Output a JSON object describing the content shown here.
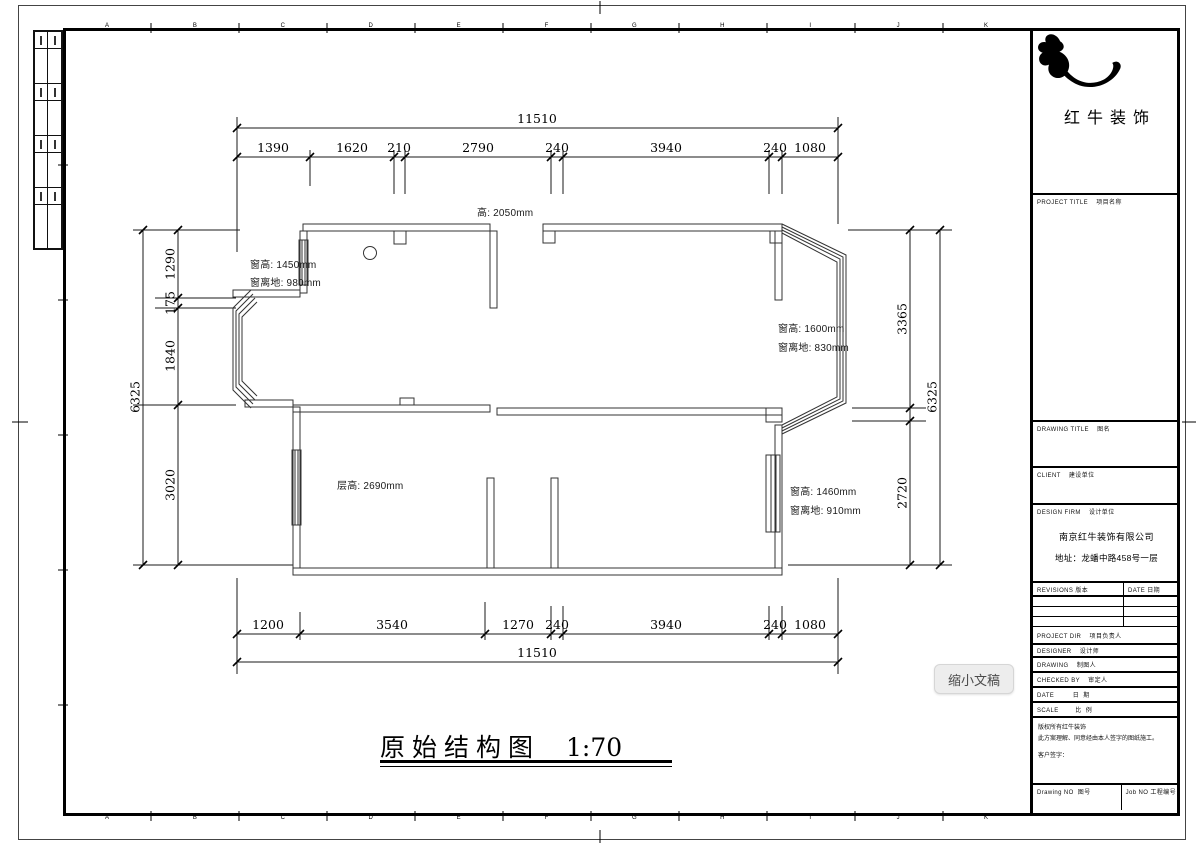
{
  "page": {
    "overlay_label": "缩小文稿"
  },
  "sheet_title": {
    "title": "原始结构图",
    "scale": "1:70"
  },
  "plan": {
    "grid_letters": [
      "A",
      "B",
      "C",
      "D",
      "E",
      "F",
      "G",
      "H",
      "I",
      "J",
      "K"
    ],
    "dims": {
      "top_total": "11510",
      "top": [
        "1390",
        "1620",
        "210",
        "2790",
        "240",
        "3940",
        "240",
        "1080"
      ],
      "bottom": [
        "1200",
        "3540",
        "1270",
        "240",
        "3940",
        "240",
        "1080"
      ],
      "bottom_total": "11510",
      "left": [
        "1290",
        "175",
        "1840",
        "3020"
      ],
      "left_total": "6325",
      "right": [
        "3365",
        "2720"
      ],
      "right_total": "6325"
    },
    "annotations": {
      "door_height": "高: 2050mm",
      "win1_height": "窗高: 1450mm",
      "win1_sill": "窗离地: 980mm",
      "win2_height": "窗高: 1600mm",
      "win2_sill": "窗离地: 830mm",
      "win3_height": "窗高: 1460mm",
      "win3_sill": "窗离地: 910mm",
      "floor_height": "层高: 2690mm"
    }
  },
  "title_block": {
    "logo_text": "红牛装饰",
    "project_title": "PROJECT TITLE    项目名称",
    "drawing_title": "DRAWING TITLE    图名",
    "client": "CLIENT    建设单位",
    "design_firm": "DESIGN FIRM    设计单位",
    "company": "南京红牛装饰有限公司",
    "address": "地址：龙蟠中路458号一层",
    "revisions": "REVISIONS 版本",
    "date_col": "DATE 日期",
    "project_dir": "PROJECT DIR    项目负责人",
    "designer": "DESIGNER    设计师",
    "drawing": "DRAWING    制图人",
    "checked_by": "CHECKED BY    审定人",
    "date_row": "DATE         日  期",
    "scale_row": "SCALE        比  例",
    "notice_1": "版权所有红牛装饰",
    "notice_2": "此方案理解、同意经由本人签字的图纸施工。",
    "notice_3": "客户签字：",
    "drawing_no": "Drawing NO  图号",
    "job_no": "Job NO 工程编号"
  }
}
